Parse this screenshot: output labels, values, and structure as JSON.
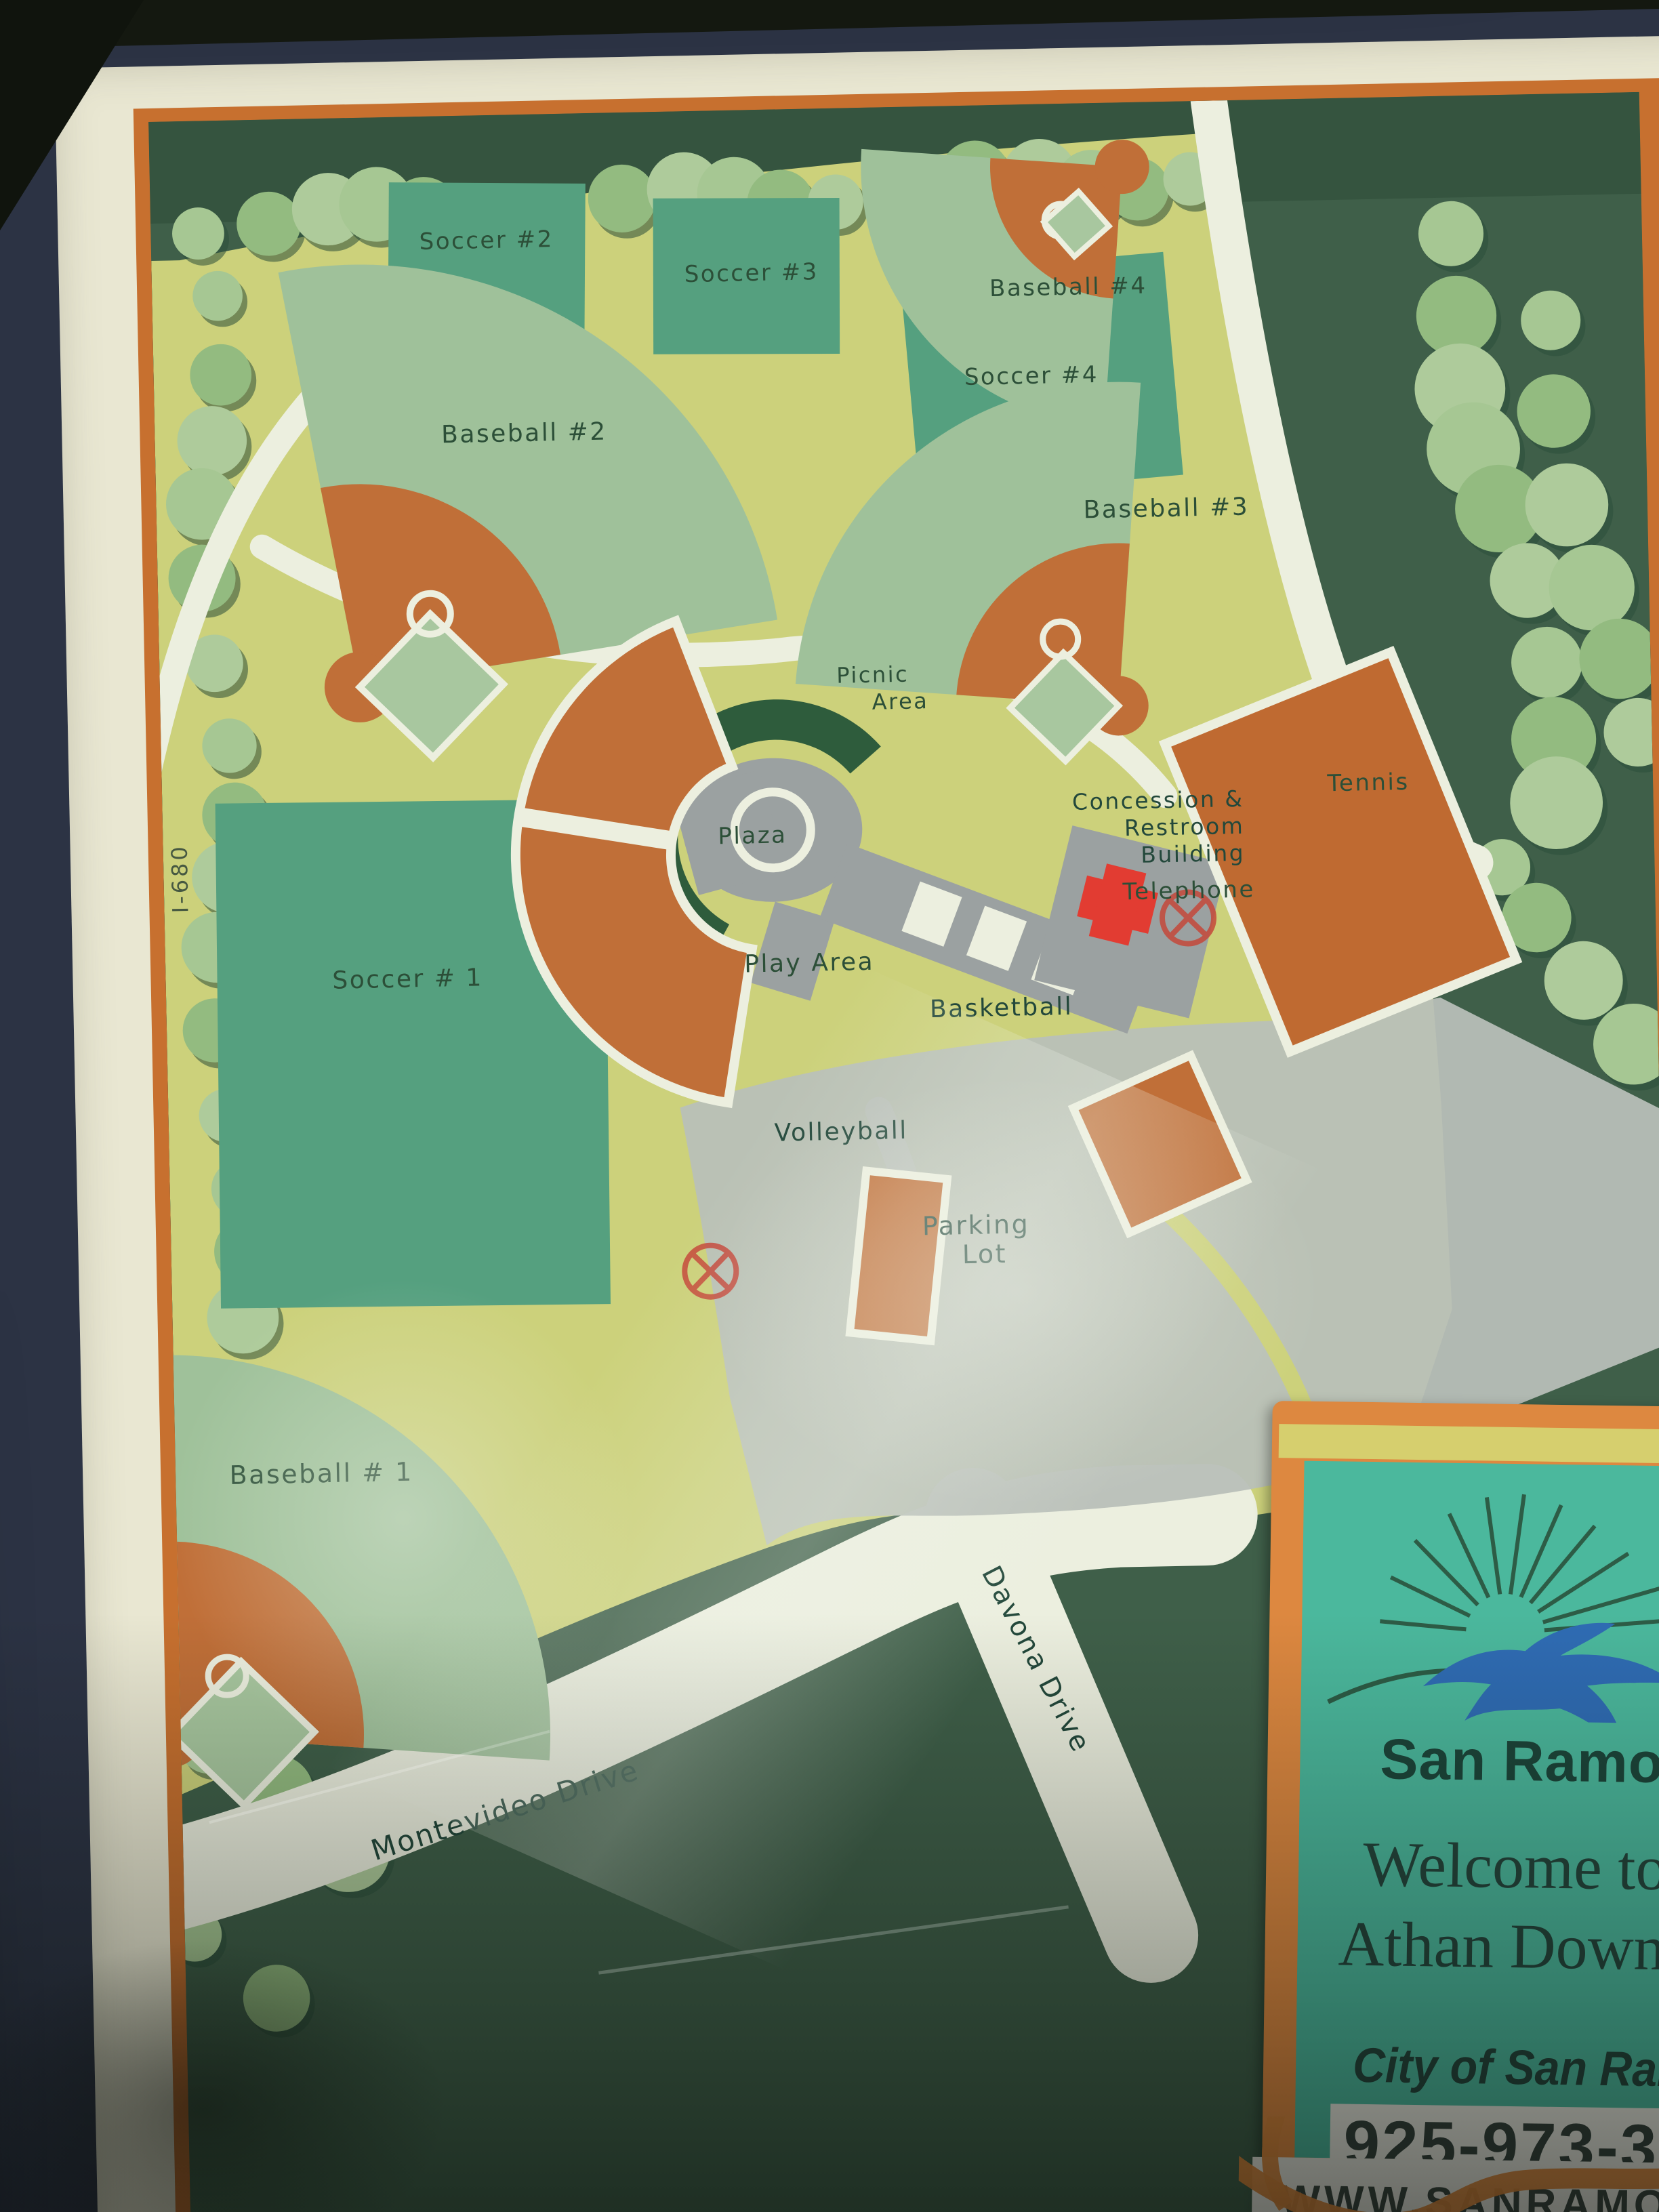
{
  "map": {
    "labels": {
      "soccer1": "Soccer # 1",
      "soccer2": "Soccer #2",
      "soccer3": "Soccer #3",
      "soccer4": "Soccer #4",
      "baseball1": "Baseball # 1",
      "baseball2": "Baseball #2",
      "baseball3": "Baseball #3",
      "baseball4": "Baseball #4",
      "tennis": "Tennis",
      "plaza": "Plaza",
      "telephone": "Telephone",
      "play_area": "Play Area",
      "basketball": "Basketball",
      "volleyball": "Volleyball",
      "picnic": [
        "Picnic",
        "Area"
      ],
      "concession": [
        "Concession &",
        "Restroom",
        "Building"
      ],
      "parking": [
        "Parking",
        "Lot"
      ],
      "montevideo": "Montevideo Drive",
      "davona": "Davona Drive",
      "freeway": "I-680"
    },
    "icons": {
      "phone_building": "telephone-building-icon",
      "marker": "crossed-circle-marker"
    }
  },
  "sign": {
    "city_name": "San Ramon",
    "welcome_line1": "Welcome to",
    "welcome_line2": "Athan Downs",
    "attribution": "City of San Ramon",
    "phone": "925-973-320",
    "website": "WWW.SANRAMON.CA"
  },
  "colors": {
    "park_green": "#ccd17b",
    "field_green": "#55a07f",
    "outfield_green": "#9fc19a",
    "court_orange": "#c06f38",
    "map_background": "#3f5f49",
    "road_white": "#ecefdf",
    "sign_teal": "#4bb89d",
    "sign_orange": "#dd8840",
    "frame_navy": "#2c3344",
    "building_red": "#e23c32"
  }
}
